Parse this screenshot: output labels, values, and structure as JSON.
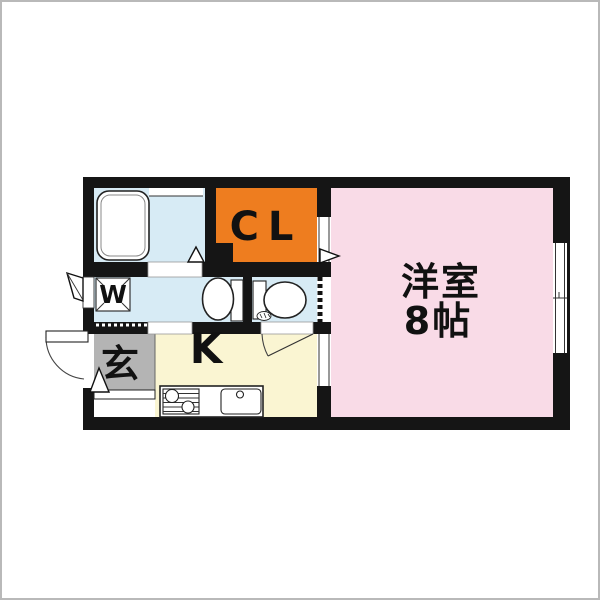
{
  "plan": {
    "type": "japanese-apartment-floor-plan",
    "rooms": {
      "western_room": {
        "label_line1": "洋室",
        "label_line2": "8帖"
      },
      "closet": {
        "label": "CL"
      },
      "kitchen": {
        "label": "K"
      },
      "entrance": {
        "label": "玄"
      },
      "laundry": {
        "label": "W"
      }
    },
    "fixtures": [
      "bathtub",
      "bath-door-marker",
      "washing-machine-pan",
      "wash-basin",
      "vanity-cabinet",
      "toilet",
      "toilet-door-swing",
      "kitchen-counter",
      "stove",
      "kitchen-sink",
      "entrance-door-swing",
      "entrance-step",
      "entrance-step-marker",
      "closet-door-marker",
      "side-window-flap",
      "sliding-window"
    ],
    "colors": {
      "wall": "#151515",
      "western_room": "#f9dbe7",
      "closet": "#ee7d1f",
      "closet_text": "#2e0700",
      "wet_room": "#d7ebf5",
      "kitchen": "#faf5d2",
      "entrance": "#b4b4b4",
      "floor_white": "#ffffff",
      "frame": "#b9b9b9",
      "text": "#111111"
    }
  }
}
